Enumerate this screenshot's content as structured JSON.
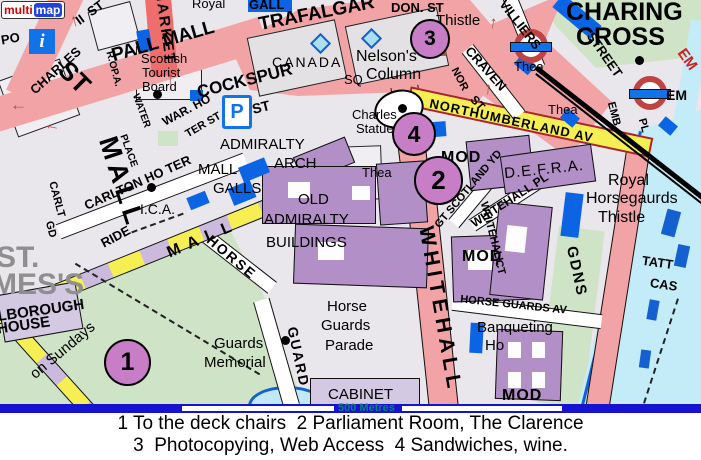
{
  "logo": {
    "part1": "multi",
    "part2": "map"
  },
  "icons": {
    "info": "i",
    "parking": "P"
  },
  "scalebar": {
    "distance": "500 Metres",
    "copyright_symbol": "©",
    "copyright_text": " Collins Bartholomew Ltd 2003"
  },
  "caption": {
    "line1": "1 To the deck chairs  2 Parliament Room, The Clarence",
    "line2": "3  Photocopying, Web Access  4 Sandwiches, wine."
  },
  "palette": {
    "background": "#e9e6ec",
    "park": "#cfe3c6",
    "water": "#c3ecf8",
    "road_pink": "#f2a3a6",
    "road_red": "#ee6e6e",
    "road_yellow": "#f6ef53",
    "mall_purple": "#cbb9de",
    "building_lavender": "#d3c9e2",
    "building_purple": "#b28fc6",
    "building_blue": "#0b64e4",
    "marker_fill": "#c77ec7",
    "scalebar_blue": "#1513d0",
    "scale_text": "#0d807c",
    "copyright_text": "#d4daee",
    "copyright_symbol": "#f0a030",
    "underground_red": "#bf4343",
    "underground_blue": "#1173e8",
    "district_grey": "#8f8f8f",
    "arrow_red": "#b34d4d"
  },
  "map": {
    "markers": [
      {
        "label": "1",
        "x": 104,
        "y": 339,
        "d": 43
      },
      {
        "label": "2",
        "x": 414,
        "y": 156,
        "d": 45
      },
      {
        "label": "3",
        "x": 410,
        "y": 19,
        "d": 36
      },
      {
        "label": "4",
        "x": 392,
        "y": 112,
        "d": 40
      }
    ],
    "arrows": [
      {
        "g": "↑",
        "x": 70,
        "y": 12,
        "r": -15
      },
      {
        "g": "↑",
        "x": 166,
        "y": 70,
        "r": 0
      },
      {
        "g": "←",
        "x": 44,
        "y": 116,
        "r": 12
      },
      {
        "g": "←",
        "x": 10,
        "y": 96,
        "r": 0
      },
      {
        "g": "↑",
        "x": 489,
        "y": 14,
        "r": 8
      },
      {
        "g": "↑",
        "x": 484,
        "y": 80,
        "r": 5
      },
      {
        "g": "↘",
        "x": 434,
        "y": 42,
        "r": 0
      }
    ],
    "labels": [
      {
        "t": "PO",
        "x": 1,
        "y": 32,
        "s": 13,
        "r": -10,
        "w": 700
      },
      {
        "t": "CHARLES",
        "x": 24,
        "y": 64,
        "s": 13,
        "r": -42,
        "w": 700
      },
      {
        "t": "II  ST",
        "x": 74,
        "y": 6,
        "s": 13,
        "r": -36,
        "w": 700
      },
      {
        "t": "ST",
        "x": 58,
        "y": 64,
        "s": 26,
        "r": 45,
        "w": 700
      },
      {
        "t": "MALL",
        "x": 74,
        "y": 169,
        "s": 27,
        "r": 72,
        "w": 700,
        "sp": 5
      },
      {
        "t": "MARKET",
        "x": 127,
        "y": 19,
        "s": 15,
        "r": 82,
        "w": 700,
        "sp": 2
      },
      {
        "t": "Royal",
        "x": 192,
        "y": -3,
        "s": 13
      },
      {
        "t": "GALL",
        "x": 249,
        "y": -2,
        "s": 13,
        "w": 700
      },
      {
        "t": "PALL MALL",
        "x": 110,
        "y": 32,
        "s": 19,
        "r": -16,
        "w": 700
      },
      {
        "t": "TRAFALGAR",
        "x": 258,
        "y": 4,
        "s": 19,
        "r": -11,
        "w": 700
      },
      {
        "t": "DON. ST",
        "x": 391,
        "y": 1,
        "s": 13,
        "w": 700
      },
      {
        "t": "Thistle",
        "x": 436,
        "y": 13,
        "s": 15
      },
      {
        "t": "VILLIERS",
        "x": 491,
        "y": 18,
        "s": 13,
        "r": 52,
        "w": 700
      },
      {
        "t": "CHARING",
        "x": 566,
        "y": 0,
        "s": 25,
        "w": 700
      },
      {
        "t": "CROSS",
        "x": 576,
        "y": 25,
        "s": 25,
        "w": 700
      },
      {
        "t": "STREET",
        "x": 579,
        "y": 48,
        "s": 13,
        "r": 55,
        "w": 700
      },
      {
        "t": "CRAVEN",
        "x": 459,
        "y": 62,
        "s": 13,
        "r": 48,
        "w": 700
      },
      {
        "t": "ST",
        "x": 470,
        "y": 97,
        "s": 12,
        "r": 48,
        "w": 700
      },
      {
        "t": "Scottish",
        "x": 141,
        "y": 52,
        "s": 13
      },
      {
        "t": "Tourist",
        "x": 142,
        "y": 66,
        "s": 13
      },
      {
        "t": "Board",
        "x": 142,
        "y": 80,
        "s": 13
      },
      {
        "t": "WAR. HO",
        "x": 160,
        "y": 104,
        "s": 12,
        "r": -28,
        "w": 700
      },
      {
        "t": "TER ST",
        "x": 184,
        "y": 120,
        "s": 11,
        "r": -30,
        "w": 700
      },
      {
        "t": "WATER",
        "x": 123,
        "y": 106,
        "s": 10,
        "r": 70,
        "w": 700
      },
      {
        "t": "PLACE",
        "x": 111,
        "y": 146,
        "s": 10,
        "r": 70,
        "w": 700
      },
      {
        "t": "R.OP.A.",
        "x": 95,
        "y": 64,
        "s": 10,
        "r": 75,
        "w": 700
      },
      {
        "t": "COCKSPUR",
        "x": 196,
        "y": 72,
        "s": 17,
        "r": -14,
        "w": 700
      },
      {
        "t": "ST",
        "x": 252,
        "y": 100,
        "s": 14,
        "r": -14,
        "w": 700
      },
      {
        "t": "CANADA",
        "x": 272,
        "y": 55,
        "s": 14,
        "sp": 2
      },
      {
        "t": "SQ",
        "x": 344,
        "y": 73,
        "s": 13
      },
      {
        "t": "Nelson's",
        "x": 356,
        "y": 49,
        "s": 16
      },
      {
        "t": "Column",
        "x": 366,
        "y": 67,
        "s": 16
      },
      {
        "t": "NORTHUMBERLAND AV",
        "x": 428,
        "y": 114,
        "s": 13,
        "r": 12,
        "w": 700,
        "sp": 1
      },
      {
        "t": "Charles",
        "x": 352,
        "y": 108,
        "s": 13
      },
      {
        "t": "Statue",
        "x": 356,
        "y": 122,
        "s": 13
      },
      {
        "t": "Thea",
        "x": 362,
        "y": 166,
        "s": 13
      },
      {
        "t": "Thea",
        "x": 514,
        "y": 60,
        "s": 13
      },
      {
        "t": "Thea",
        "x": 548,
        "y": 103,
        "s": 13
      },
      {
        "t": "MOD",
        "x": 441,
        "y": 150,
        "s": 16,
        "w": 700,
        "sp": 1
      },
      {
        "t": "MOD",
        "x": 462,
        "y": 249,
        "s": 16,
        "w": 700,
        "sp": 1
      },
      {
        "t": "MOD",
        "x": 502,
        "y": 388,
        "s": 16,
        "w": 700,
        "sp": 1
      },
      {
        "t": "GT SCOTLAND YD",
        "x": 420,
        "y": 184,
        "s": 11,
        "r": -50,
        "w": 700
      },
      {
        "t": "D.E.F.R.A.",
        "x": 504,
        "y": 162,
        "s": 15,
        "r": -6,
        "sp": 1
      },
      {
        "t": "Royal",
        "x": 608,
        "y": 173,
        "s": 16
      },
      {
        "t": "Horsegaurds",
        "x": 586,
        "y": 191,
        "s": 16
      },
      {
        "t": "Thistle",
        "x": 598,
        "y": 210,
        "s": 16
      },
      {
        "t": "WHITEHALL PL",
        "x": 465,
        "y": 194,
        "s": 12,
        "r": -33,
        "w": 700
      },
      {
        "t": "WHITEHALL",
        "x": 459,
        "y": 228,
        "s": 11,
        "r": 75,
        "w": 700
      },
      {
        "t": "CT",
        "x": 492,
        "y": 262,
        "s": 11,
        "r": 75,
        "w": 700
      },
      {
        "t": "GDNS",
        "x": 551,
        "y": 264,
        "s": 15,
        "r": 78,
        "w": 700,
        "sp": 2
      },
      {
        "t": "WHITEHALL",
        "x": 356,
        "y": 299,
        "s": 21,
        "r": 80,
        "w": 700,
        "sp": 5
      },
      {
        "t": "HORSE",
        "x": 202,
        "y": 250,
        "s": 14,
        "r": 40,
        "w": 700,
        "sp": 2
      },
      {
        "t": "GUARD",
        "x": 268,
        "y": 350,
        "s": 14,
        "r": 78,
        "w": 700,
        "sp": 2
      },
      {
        "t": "RIDE",
        "x": 100,
        "y": 230,
        "s": 13,
        "r": -28,
        "w": 700
      },
      {
        "t": "CARLTON HO TER",
        "x": 80,
        "y": 176,
        "s": 13,
        "r": -24,
        "w": 700
      },
      {
        "t": "I.C.A.",
        "x": 140,
        "y": 202,
        "s": 14
      },
      {
        "t": "CARLT",
        "x": 38,
        "y": 194,
        "s": 11,
        "r": 75,
        "w": 700
      },
      {
        "t": "GD",
        "x": 42,
        "y": 224,
        "s": 11,
        "r": 75,
        "w": 700
      },
      {
        "t": "MALL",
        "x": 198,
        "y": 162,
        "s": 15
      },
      {
        "t": "GALLS",
        "x": 213,
        "y": 181,
        "s": 15
      },
      {
        "t": "ADMIRALTY",
        "x": 220,
        "y": 137,
        "s": 15
      },
      {
        "t": "ARCH",
        "x": 274,
        "y": 156,
        "s": 15
      },
      {
        "t": "OLD",
        "x": 298,
        "y": 192,
        "s": 15
      },
      {
        "t": "ADMIRALTY",
        "x": 264,
        "y": 212,
        "s": 15
      },
      {
        "t": "BUILDINGS",
        "x": 266,
        "y": 235,
        "s": 15
      },
      {
        "t": "Horse",
        "x": 327,
        "y": 299,
        "s": 15
      },
      {
        "t": "Guards",
        "x": 321,
        "y": 318,
        "s": 15
      },
      {
        "t": "Parade",
        "x": 325,
        "y": 338,
        "s": 15
      },
      {
        "t": "Guards",
        "x": 214,
        "y": 336,
        "s": 15
      },
      {
        "t": "Memorial",
        "x": 204,
        "y": 355,
        "s": 15
      },
      {
        "t": "CABINET",
        "x": 328,
        "y": 387,
        "s": 15
      },
      {
        "t": "HORSE GUARDS AV",
        "x": 460,
        "y": 300,
        "s": 11,
        "r": 6,
        "w": 700
      },
      {
        "t": "Banqueting",
        "x": 477,
        "y": 320,
        "s": 15
      },
      {
        "t": "Ho",
        "x": 485,
        "y": 338,
        "s": 15
      },
      {
        "t": "TATT",
        "x": 642,
        "y": 256,
        "s": 13,
        "w": 700,
        "r": 8
      },
      {
        "t": "CAS",
        "x": 650,
        "y": 278,
        "s": 13,
        "w": 700,
        "r": 8
      },
      {
        "t": "EMB.",
        "x": 600,
        "y": 110,
        "s": 11,
        "r": 75,
        "w": 700
      },
      {
        "t": "PL",
        "x": 636,
        "y": 120,
        "s": 11,
        "r": 75,
        "w": 700
      },
      {
        "t": "EM",
        "x": 666,
        "y": 88,
        "s": 14,
        "w": 700
      },
      {
        "t": "EM",
        "x": 676,
        "y": 52,
        "s": 15,
        "w": 700,
        "c": "#cc2222",
        "r": 55
      },
      {
        "t": "NOR",
        "x": 447,
        "y": 74,
        "s": 11,
        "r": 62,
        "w": 700
      },
      {
        "t": "ST.",
        "x": -4,
        "y": 243,
        "s": 30,
        "w": 700,
        "c": "#8f8f8f"
      },
      {
        "t": "MES'S",
        "x": -8,
        "y": 270,
        "s": 30,
        "w": 700,
        "c": "#8f8f8f"
      },
      {
        "t": "LBOROUGH",
        "x": -3,
        "y": 303,
        "s": 15,
        "r": -8,
        "w": 700
      },
      {
        "t": "HOUSE",
        "x": -3,
        "y": 318,
        "s": 15,
        "r": -8,
        "w": 700
      },
      {
        "t": "on Sundays",
        "x": 23,
        "y": 343,
        "s": 15,
        "r": -40
      },
      {
        "t": "MALL",
        "x": 165,
        "y": 231,
        "s": 16,
        "r": -23,
        "w": 700,
        "sp": 8
      }
    ]
  }
}
